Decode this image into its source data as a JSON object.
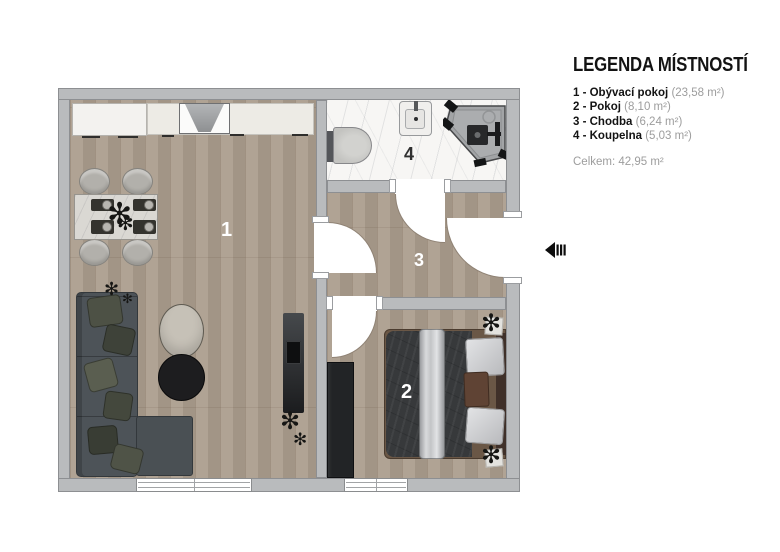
{
  "legend": {
    "title": "LEGENDA MÍSTNOSTÍ",
    "items": [
      {
        "name": "1 - Obývací pokoj",
        "area": "(23,58 m²)"
      },
      {
        "name": "2 - Pokoj",
        "area": "(8,10 m²)"
      },
      {
        "name": "3 - Chodba",
        "area": "(6,24 m²)"
      },
      {
        "name": "4 - Koupelna",
        "area": "(5,03 m²)"
      }
    ],
    "total": "Celkem: 42,95 m²"
  },
  "rooms": {
    "living": {
      "number": "1"
    },
    "bedroom": {
      "number": "2"
    },
    "hallway": {
      "number": "3"
    },
    "bathroom": {
      "number": "4"
    }
  },
  "icons": {
    "plant_glyph": "✻",
    "entry_arrow": "left-arrow"
  },
  "colors": {
    "wall": "#b9bbbd",
    "wood_floor": "#ab9d8d",
    "marble_floor": "#f7f6f4",
    "sofa": "#4d5358",
    "text_gray": "#9d9d9d"
  }
}
